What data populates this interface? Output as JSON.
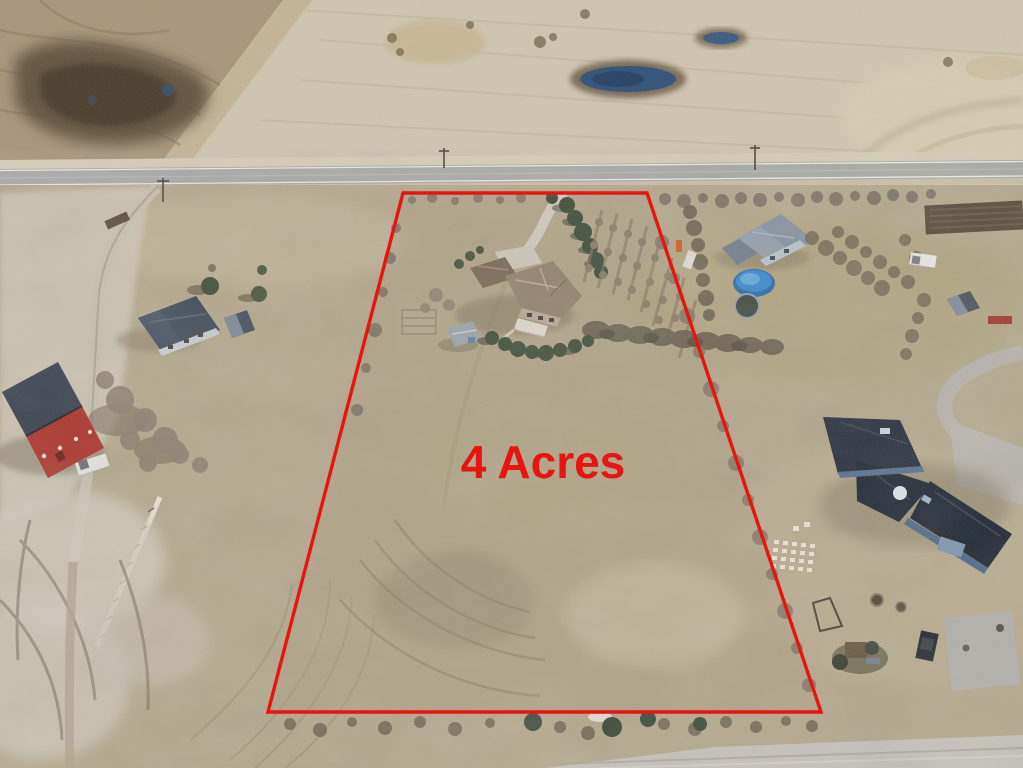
{
  "annotation": {
    "label": "4 Acres",
    "color": "#e81410",
    "font_weight": "bold"
  },
  "boundary": {
    "color": "#e81410",
    "style": "solid",
    "shape": "trapezoid-lot-outline"
  },
  "scene": {
    "type": "aerial-drone-photo",
    "features": [
      "plowed-dark-field",
      "pale-stubble-field",
      "slough-pond",
      "paved-highway",
      "farm-driveway",
      "red-barn",
      "gray-roof-house",
      "subject-two-storey-house",
      "garden-shed",
      "evergreen-windbreak",
      "orchard-tree-rows",
      "neighbor-house-with-pool",
      "trampoline",
      "dark-roof-estate-house",
      "play-structure",
      "gravel-road"
    ]
  },
  "palette": {
    "field_pale": "#cfc5b0",
    "field_plowed": "#a8947a",
    "field_wet_dark": "#4e4130",
    "grass_base": "#b4a88c",
    "road_asphalt": "#a9a9a5",
    "pond_blue": "#2f4f77",
    "barn_red": "#aa3329",
    "estate_roof_navy": "#232b37",
    "pool_blue": "#3c88cc"
  }
}
